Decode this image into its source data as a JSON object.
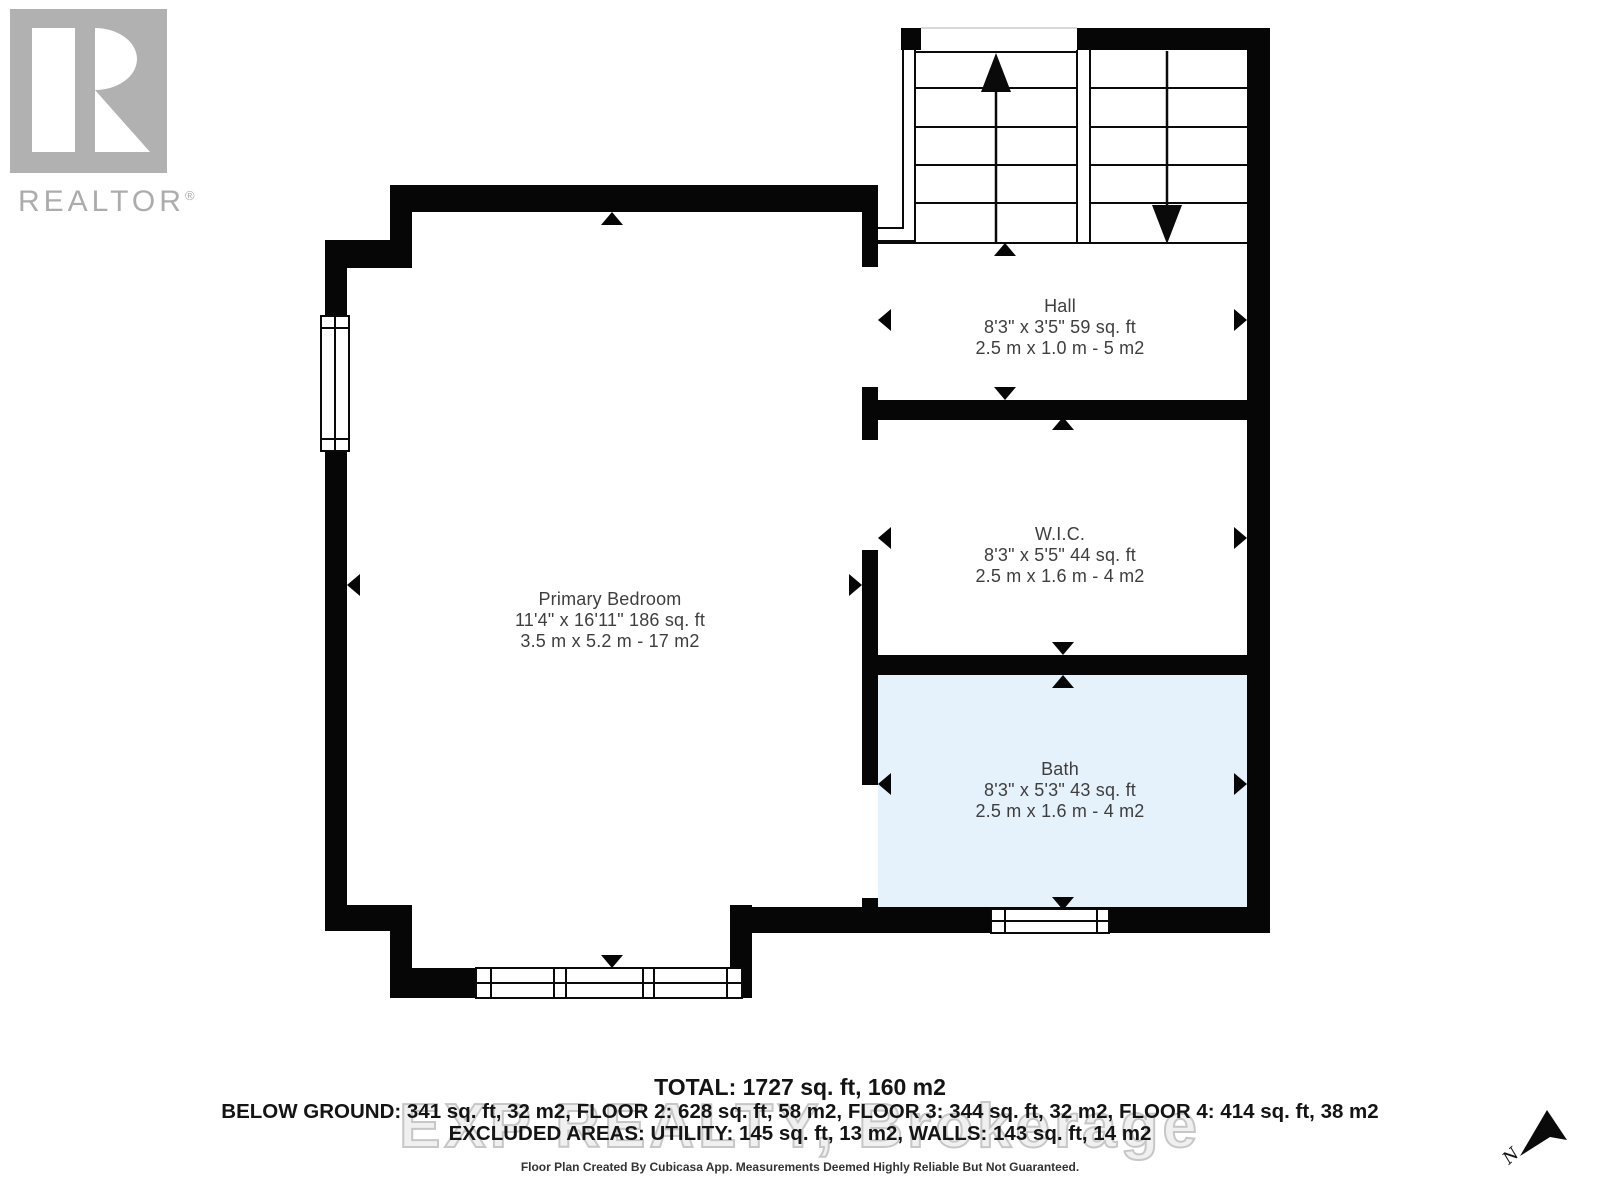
{
  "branding": {
    "logo_text": "REALTOR",
    "registered_mark": "®"
  },
  "watermark": "EXP REALTY, Brokerage",
  "rooms": [
    {
      "name": "Primary Bedroom",
      "dim_imperial": "11'4\" x 16'11\" 186 sq. ft",
      "dim_metric": "3.5 m x 5.2 m - 17 m2"
    },
    {
      "name": "Hall",
      "dim_imperial": "8'3\" x 3'5\" 59 sq. ft",
      "dim_metric": "2.5 m x 1.0 m - 5 m2"
    },
    {
      "name": "W.I.C.",
      "dim_imperial": "8'3\" x 5'5\" 44 sq. ft",
      "dim_metric": "2.5 m x 1.6 m - 4 m2"
    },
    {
      "name": "Bath",
      "dim_imperial": "8'3\" x 5'3\" 43 sq. ft",
      "dim_metric": "2.5 m x 1.6 m - 4 m2"
    }
  ],
  "summary": {
    "total": "TOTAL: 1727 sq. ft, 160 m2",
    "floors": "BELOW GROUND: 341 sq. ft, 32 m2, FLOOR 2: 628 sq. ft, 58 m2, FLOOR 3: 344 sq. ft, 32 m2, FLOOR 4: 414 sq. ft, 38 m2",
    "excluded": "EXCLUDED AREAS: UTILITY: 145 sq. ft, 13 m2, WALLS: 143 sq. ft, 14 m2"
  },
  "footer": {
    "disclaimer": "Floor Plan Created By Cubicasa App. Measurements Deemed Highly Reliable But Not Guaranteed."
  },
  "compass": {
    "label": "N"
  },
  "colors": {
    "wall": "#060606",
    "bath_fill": "#e6f2fb",
    "label_text": "#3e3e3e",
    "logo_gray": "#b1b1b1",
    "watermark_gray": "#c7c7c7"
  }
}
